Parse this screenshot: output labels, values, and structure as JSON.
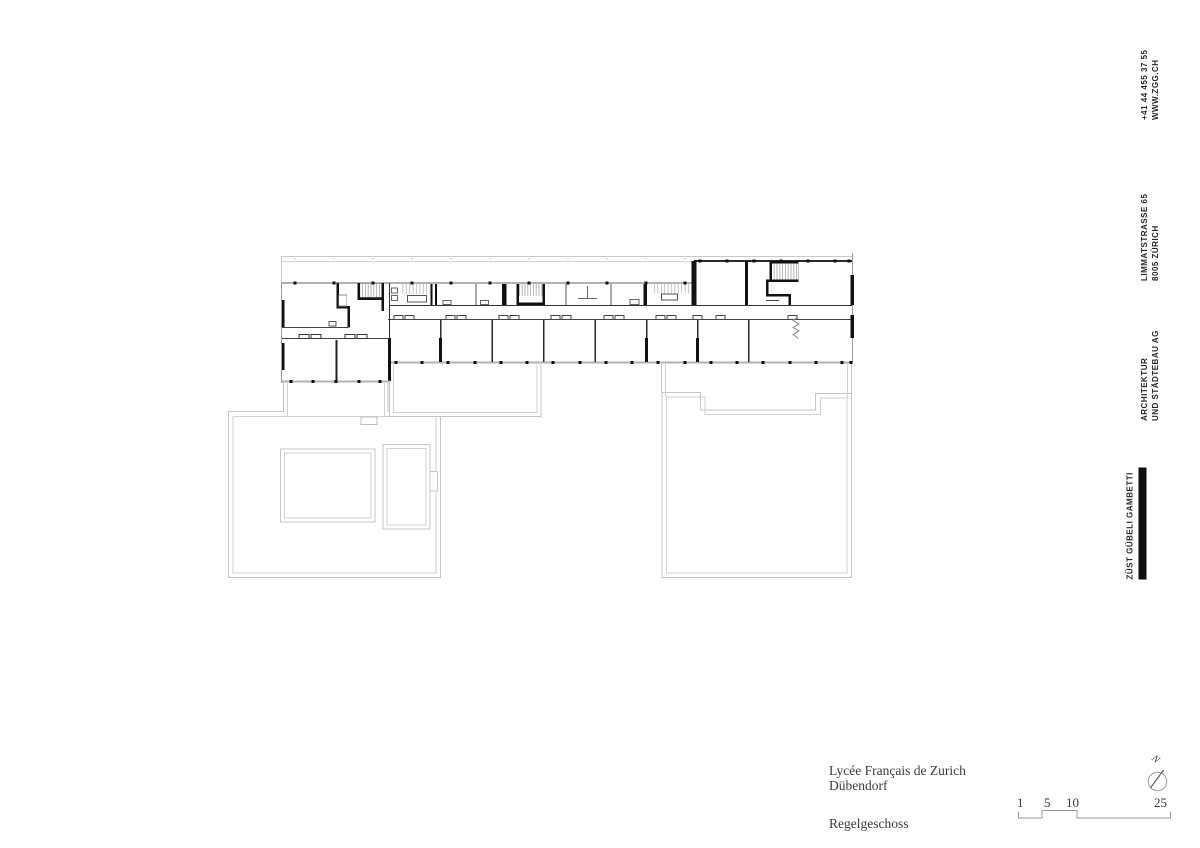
{
  "document": {
    "project_line1": "Lycée Français de Zurich",
    "project_line2": "Dübendorf",
    "drawing_title": "Regelgeschoss"
  },
  "sidebar": {
    "contact": {
      "line1": "+41 44 455 37 55",
      "line2": "WWW.ZGG.CH"
    },
    "address": {
      "line1": "LIMMATSTRASSE 65",
      "line2": "8005 ZÜRICH"
    },
    "firm_type": {
      "line1": "ARCHITEKTUR",
      "line2": "UND STÄDTEBAU AG"
    },
    "firm_name": "ZÜST GÜBELI GAMBETTI"
  },
  "scale_bar": {
    "labels": [
      "1",
      "5",
      "10",
      "25"
    ]
  },
  "north_arrow": {
    "label": "N"
  },
  "colors": {
    "wall": "#111111",
    "grey_wall": "#b2b2b2",
    "roof_line": "#c6c6c6",
    "roof_line_inner": "#d2d2d2",
    "text": "#3b3b3b",
    "brand_bar": "#101010"
  }
}
